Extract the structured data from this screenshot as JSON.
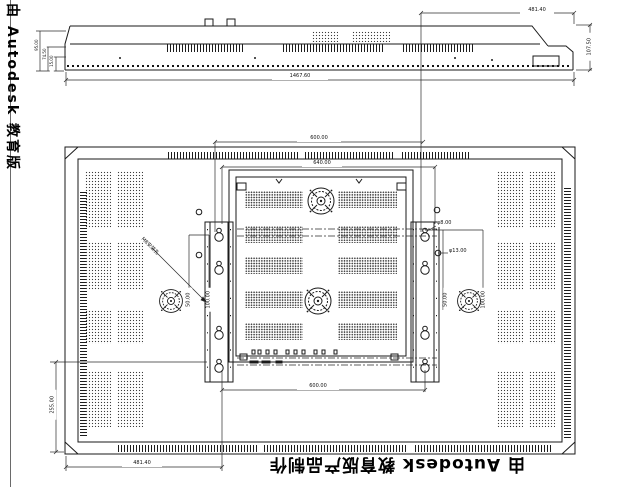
{
  "watermark": {
    "left": "由 Autodesk 教育版",
    "bottom": "由 Autodesk 教育版产品制作"
  },
  "top_view": {
    "dim_overall_width": "1467.60",
    "dim_right_offset": "481.40",
    "dim_height": "107.50",
    "dim_left_1": "95.00",
    "dim_left_2": "74.50",
    "dim_left_3": "15.00"
  },
  "rear_view": {
    "dim_vesa_width_top": "600.00",
    "dim_plate_width": "640.00",
    "dim_vesa_width_bottom": "600.00",
    "dim_bottom_left": "481.40",
    "dim_left_height": "255.00",
    "label_hole_small": "φ8.00",
    "label_hole_large": "φ13.00",
    "label_mount": "M8安装孔",
    "dim_rail_left_a": "50.00",
    "dim_rail_left_b": "100.00",
    "dim_rail_right_a": "50.00",
    "dim_rail_right_b": "100.00"
  },
  "colors": {
    "line": "#1a1a1a",
    "background": "#ffffff"
  }
}
